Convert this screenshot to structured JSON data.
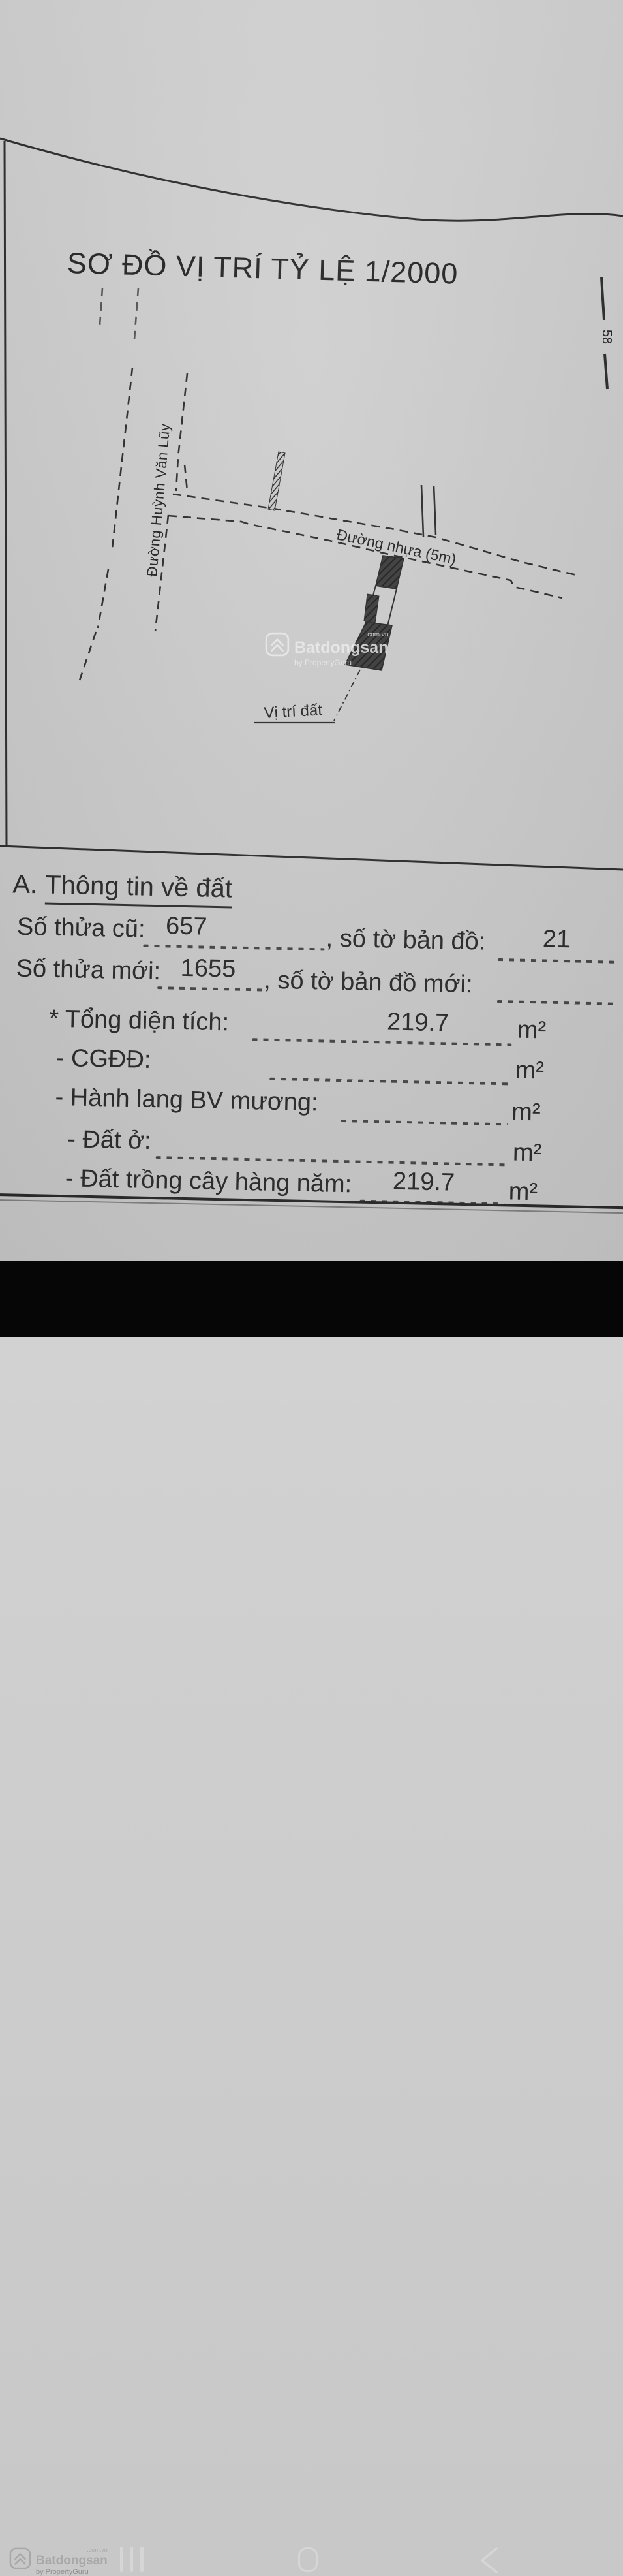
{
  "title": "SƠ ĐỒ VỊ TRÍ TỶ LỆ 1/2000",
  "map": {
    "street_vertical": "Đường Huỳnh Văn Lũy",
    "street_horizontal": "Đường nhựa (5m)",
    "parcel_label": "Vị trí đất",
    "edge_mark": "58"
  },
  "info": {
    "heading_prefix": "A.",
    "heading": "Thông tin về đất",
    "rows": [
      {
        "label": "Số thửa cũ:",
        "value": "657",
        "label2": ", số tờ bản đồ:",
        "value2": "21"
      },
      {
        "label": "Số thửa mới:",
        "value": "1655",
        "label2": ", số tờ bản đồ mới:",
        "value2": ""
      },
      {
        "label": "* Tổng diện tích:",
        "value": "219.7",
        "unit": "m²"
      },
      {
        "label": "- CGĐĐ:",
        "value": "",
        "unit": "m²"
      },
      {
        "label": "- Hành lang BV mương:",
        "value": "",
        "unit": "m²"
      },
      {
        "label": "- Đất ở:",
        "value": "",
        "unit": "m²"
      },
      {
        "label": "- Đất trồng cây hàng năm:",
        "value": "219.7",
        "unit": "m²"
      }
    ]
  },
  "watermark": {
    "brand": "Batdongsan",
    "domain": ".com.vn",
    "byline": "by PropertyGuru"
  },
  "navbar": {
    "recents_icon": "recents",
    "home_icon": "home",
    "back_icon": "back"
  },
  "colors": {
    "paper": "#cdcdcd",
    "ink": "#2b2b2b",
    "navbar_bg": "#060606",
    "nav_icon": "#d6d6d6",
    "watermark": "#eeeeee"
  }
}
